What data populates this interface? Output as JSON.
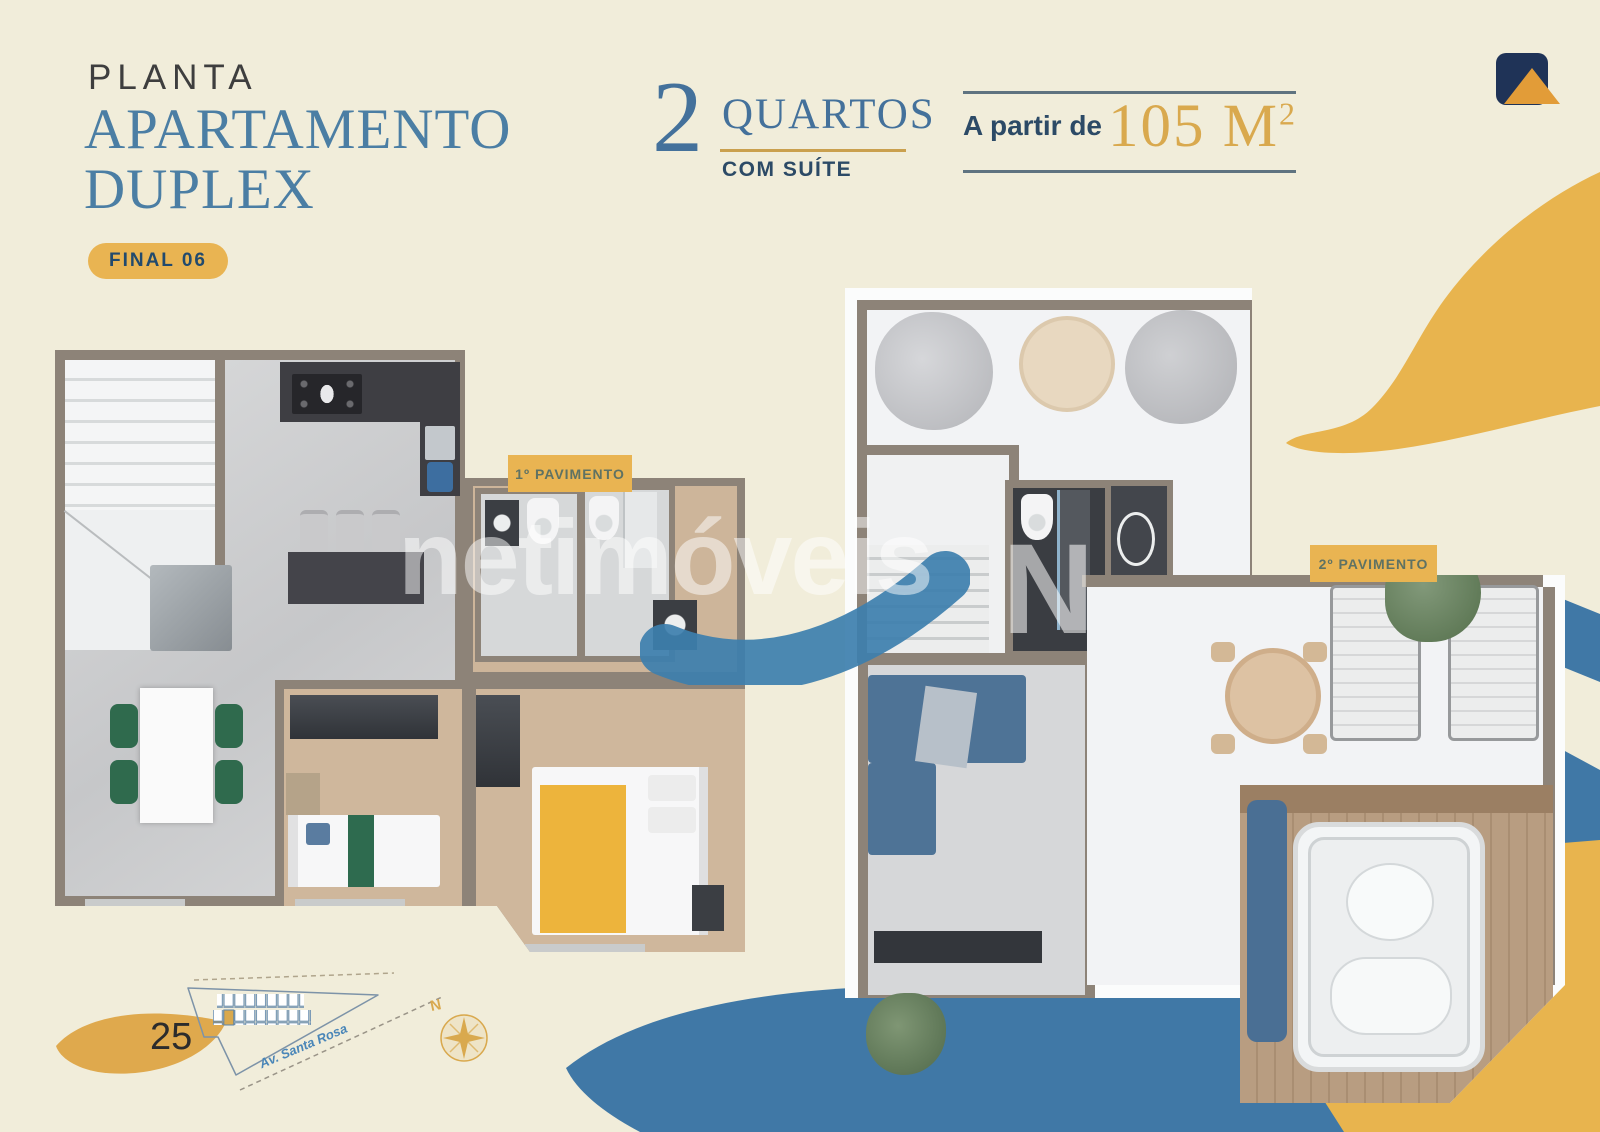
{
  "header": {
    "kicker": "PLANTA",
    "title_line1": "APARTAMENTO",
    "title_line2": "DUPLEX",
    "unit_badge": "FINAL 06"
  },
  "specs": {
    "rooms_number": "2",
    "rooms_label": "QUARTOS",
    "rooms_sublabel": "COM SUÍTE",
    "area_prefix": "A partir de",
    "area_value": "105 M",
    "area_sup": "2"
  },
  "floor_labels": {
    "first": "1º PAVIMENTO",
    "second": "2º PAVIMENTO"
  },
  "watermark": {
    "text": "netimóveis",
    "mark": "N"
  },
  "footer": {
    "page_number": "25",
    "street_label": "Av. Santa Rosa",
    "compass_north": "N"
  },
  "colors": {
    "background": "#f1edda",
    "gold": "#e8b44e",
    "wave_blue": "#4078a6",
    "navy": "#1f3357",
    "steel_blue": "#4b7ea4",
    "dark_navy": "#2c4a66",
    "badge_fill": "#e9b452",
    "badge_text": "#5f7263",
    "area_gold": "#d9a94e"
  }
}
